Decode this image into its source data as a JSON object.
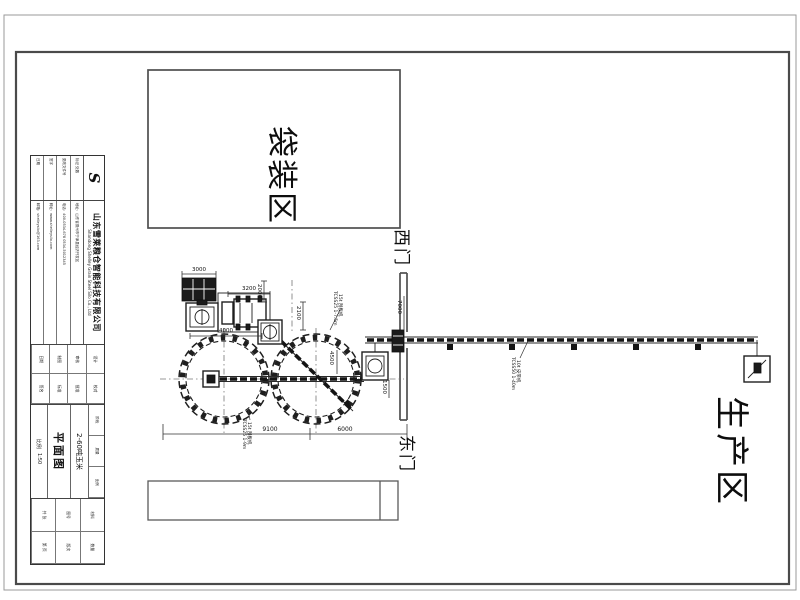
{
  "colors": {
    "paper": "#ffffff",
    "line_dark": "#1f1f1f",
    "wall_gray": "#4f4f4f",
    "border_outer": "#9a9a9a"
  },
  "areas": {
    "bagging": {
      "label": "袋装区"
    },
    "production": {
      "label": "生产区"
    },
    "west_gate": {
      "label": "西门"
    },
    "east_gate": {
      "label": "东门"
    }
  },
  "title_block": {
    "logo_letter": "S",
    "company_cn": "山东雪莱粮仓智能科技有限公司",
    "company_en": "Shandong Shelley Grain Steel Silo Co., Ltd",
    "rev_rows": [
      "标记 处数",
      "更改文件号",
      "签字",
      "日期"
    ],
    "fine_print": [
      "地址：山东省德州市宁津县经济开发区",
      "电话：400-0534-678  0534-5012345",
      "网址：www.shelleysilo.com",
      "邮箱：shelleysilo@163.com"
    ],
    "approval_cells": [
      "设计",
      "校对",
      "审核",
      "批准",
      "制图",
      "标准",
      "日期",
      "签名"
    ],
    "stage_cells": [
      "阶段",
      "质量",
      "比例"
    ],
    "project": "2-60吨玉米",
    "drawing_title": "平面图",
    "scale_label": "比例",
    "scale": "1:50",
    "footer_cells": [
      "材料",
      "数量",
      "图号",
      "版次",
      "共 张",
      "第 页"
    ]
  },
  "annotations": [
    {
      "n": "dim-3000",
      "t": "3000",
      "x": 199,
      "y": 268,
      "r": 0,
      "s": 5.5
    },
    {
      "n": "dim-2000",
      "t": "2000",
      "x": 261,
      "y": 284,
      "r": 90,
      "s": 5.5
    },
    {
      "n": "dim-3200",
      "t": "3200",
      "x": 249,
      "y": 287,
      "r": 0,
      "s": 5.5
    },
    {
      "n": "dim-2100",
      "t": "2100",
      "x": 300,
      "y": 306,
      "r": 90,
      "s": 5.5
    },
    {
      "n": "dim-4000",
      "t": "4000",
      "x": 226,
      "y": 329,
      "r": 0,
      "s": 5.5
    },
    {
      "n": "dim-7000",
      "t": "7000",
      "x": 401,
      "y": 300,
      "r": 90,
      "s": 5.5
    },
    {
      "n": "dim-4500",
      "t": "4500",
      "x": 333,
      "y": 351,
      "r": 90,
      "s": 5.5
    },
    {
      "n": "dim-1500",
      "t": "1500",
      "x": 386,
      "y": 380,
      "r": 90,
      "s": 5.5
    },
    {
      "n": "dim-9100",
      "t": "9100",
      "x": 270,
      "y": 427,
      "r": 0,
      "s": 6
    },
    {
      "n": "dim-6000",
      "t": "6000",
      "x": 345,
      "y": 427,
      "r": 0,
      "s": 6
    },
    {
      "n": "label-scraper-1-model",
      "t": "TCSS25 1-7.5m",
      "x": 336,
      "y": 291,
      "r": 90,
      "s": 4.5
    },
    {
      "n": "label-scraper-1-type",
      "t": "15t 刮板机",
      "x": 341,
      "y": 294,
      "r": 90,
      "s": 4.5
    },
    {
      "n": "label-scraper-2-model",
      "t": "TCSS25 1-9m",
      "x": 245,
      "y": 419,
      "r": 90,
      "s": 4.5
    },
    {
      "n": "label-scraper-2-type",
      "t": "15t 刮板机",
      "x": 250,
      "y": 422,
      "r": 90,
      "s": 4.5
    },
    {
      "n": "label-belt-model",
      "t": "TCSS50 1-40m",
      "x": 514,
      "y": 357,
      "r": 90,
      "s": 4.5
    },
    {
      "n": "label-belt-type",
      "t": "10t 皮带机",
      "x": 519,
      "y": 360,
      "r": 90,
      "s": 4.5
    }
  ]
}
